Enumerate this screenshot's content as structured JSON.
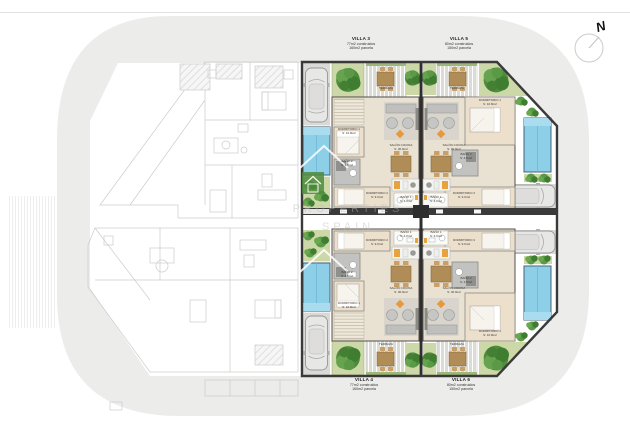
{
  "title": "Site floor plan – Villas 3/4/5/6",
  "compass": {
    "label": "N"
  },
  "watermark": {
    "line1": "PROPERTIES",
    "line2": "SPAIN",
    "logo": "house-icon"
  },
  "villas": [
    {
      "id": "villa-3",
      "name": "VILLA 3",
      "built": "77m2 construidos",
      "plot": "160m2 parcela",
      "rooms": {
        "terraza": {
          "n": "TERRAZA",
          "a": "S: 10.0m2"
        },
        "salon": {
          "n": "SALÓN COCINA",
          "a": "S: 30.9m2"
        },
        "dorm1": {
          "n": "DORMITORIO 1",
          "a": "S: 10.8m2"
        },
        "dorm2": {
          "n": "DORMITORIO 2",
          "a": "S: 9.0m2"
        },
        "bano1": {
          "n": "BAÑO 1",
          "a": "S: 4.0m2"
        },
        "bano2": {
          "n": "BAÑO 2",
          "a": "S: 4.5m2"
        }
      }
    },
    {
      "id": "villa-5",
      "name": "VILLA 5",
      "built": "80m2 construidos",
      "plot": "150m2 parcela",
      "rooms": {
        "terraza": {
          "n": "TERRAZA",
          "a": "S: 10.0m2"
        },
        "salon": {
          "n": "SALÓN COCINA",
          "a": "S: 30.9m2"
        },
        "dorm1": {
          "n": "DORMITORIO 1",
          "a": "S: 10.8m2"
        },
        "dorm3": {
          "n": "DORMITORIO 3",
          "a": "S: 9.0m2"
        },
        "bano1": {
          "n": "BAÑO 1",
          "a": "S: 4.0m2"
        },
        "bano2": {
          "n": "BAÑO 2",
          "a": "S: 4.5m2"
        }
      }
    },
    {
      "id": "villa-4",
      "name": "VILLA 4",
      "built": "77m2 construidos",
      "plot": "160m2 parcela",
      "rooms": {
        "terraza": {
          "n": "TERRAZA",
          "a": "S: 10.0m2"
        },
        "salon": {
          "n": "SALÓN COCINA",
          "a": "S: 30.9m2"
        },
        "dorm1": {
          "n": "DORMITORIO 1",
          "a": "S: 10.8m2"
        },
        "dorm2": {
          "n": "DORMITORIO 2",
          "a": "S: 9.0m2"
        },
        "bano1": {
          "n": "BAÑO 1",
          "a": "S: 4.0m2"
        },
        "bano2": {
          "n": "BAÑO 2",
          "a": "S: 4.5m2"
        }
      }
    },
    {
      "id": "villa-6",
      "name": "VILLA 6",
      "built": "80m2 construidos",
      "plot": "150m2 parcela",
      "rooms": {
        "terraza": {
          "n": "TERRAZA",
          "a": "S: 10.0m2"
        },
        "salon": {
          "n": "SALÓN COCINA",
          "a": "S: 30.9m2"
        },
        "dorm1": {
          "n": "DORMITORIO 1",
          "a": "S: 10.8m2"
        },
        "dorm3": {
          "n": "DORMITORIO 3",
          "a": "S: 9.0m2"
        },
        "bano1": {
          "n": "BAÑO 1",
          "a": "S: 4.0m2"
        },
        "bano2": {
          "n": "BAÑO 2",
          "a": "S: 4.5m2"
        }
      }
    }
  ],
  "colors": {
    "street_band": "#ececeb",
    "wall": "#3a3a3a",
    "floor_beige": "#e9e1d1",
    "pool_blue": "#8ccfe7",
    "tree_green": "#4e8c3c",
    "planter_green": "#cdd8a8",
    "accent_orange": "#e8973a",
    "wood_brown": "#b08d57",
    "ghost_line": "#c9c9c9"
  }
}
